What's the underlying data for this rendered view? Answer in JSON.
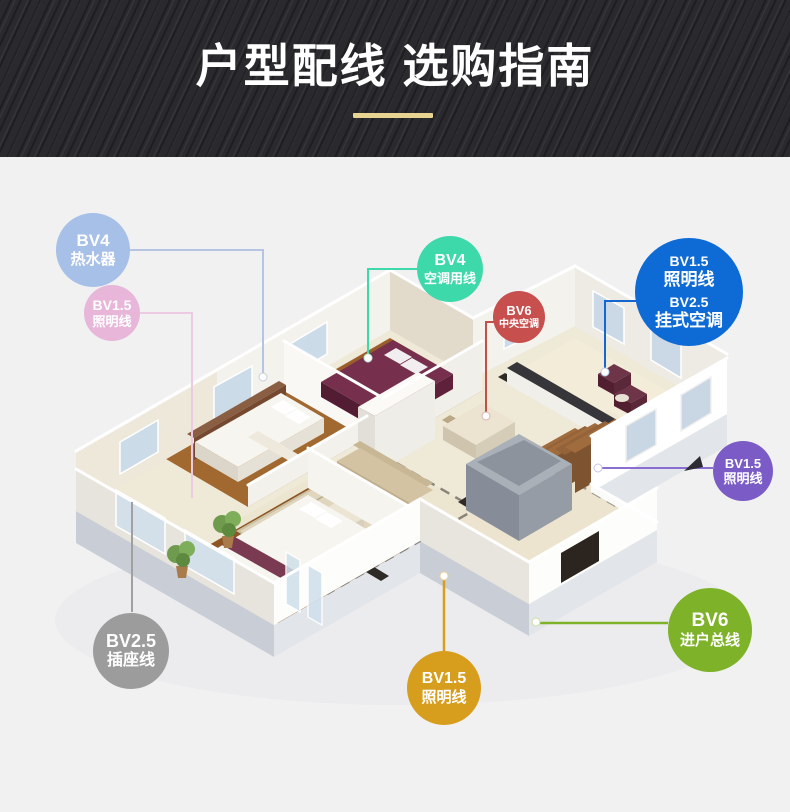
{
  "page": {
    "background": "#f1f1f2"
  },
  "header": {
    "title": "户型配线 选购指南",
    "background": "#2a2a2e",
    "text_color": "#ffffff",
    "accent_bar_color": "#e8d491"
  },
  "floorplan": {
    "type": "3d-isometric-apartment-cutaway"
  },
  "badges": [
    {
      "id": "water-heater",
      "color": "#a7c0e8",
      "line_color": "#b5c4e2",
      "lines": [
        "BV4",
        "热水器"
      ]
    },
    {
      "id": "lighting-left",
      "color": "#e7b6d9",
      "line_color": "#eccae2",
      "lines": [
        "BV1.5",
        "照明线"
      ]
    },
    {
      "id": "ac-supply",
      "color": "#3ed9ab",
      "line_color": "#3ed9ab",
      "lines": [
        "BV4",
        "空调用线"
      ]
    },
    {
      "id": "central-ac",
      "color": "#c7504f",
      "line_color": "#c05048",
      "lines": [
        "BV6",
        "中央空调"
      ]
    },
    {
      "id": "wall-ac",
      "color": "#0e6bd6",
      "line_color": "#1566cf",
      "lines": [
        "BV1.5",
        "照明线",
        "BV2.5",
        "挂式空调"
      ]
    },
    {
      "id": "lighting-right",
      "color": "#7b5cc6",
      "line_color": "#8a6fd0",
      "lines": [
        "BV1.5",
        "照明线"
      ]
    },
    {
      "id": "main-inlet",
      "color": "#7eb229",
      "line_color": "#7eb229",
      "lines": [
        "BV6",
        "进户总线"
      ]
    },
    {
      "id": "socket-line",
      "color": "#9c9c9c",
      "line_color": "#a0a0a0",
      "lines": [
        "BV2.5",
        "插座线"
      ]
    },
    {
      "id": "lighting-bottom",
      "color": "#d79e1e",
      "line_color": "#d79e1e",
      "lines": [
        "BV1.5",
        "照明线"
      ]
    }
  ]
}
